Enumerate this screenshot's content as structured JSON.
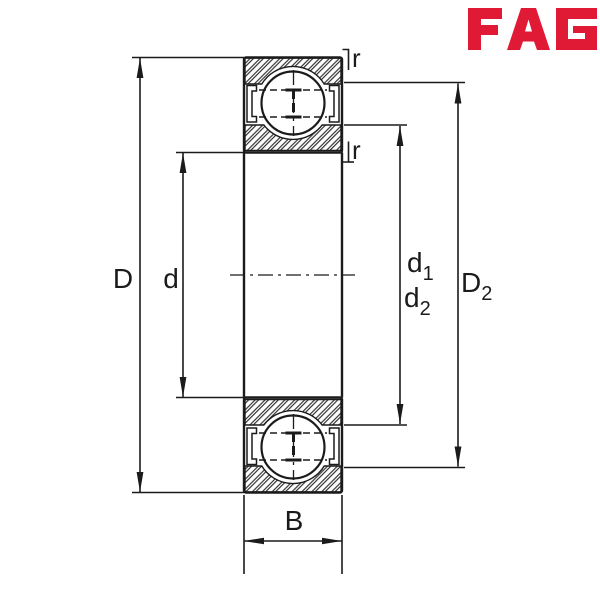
{
  "page": {
    "title": "Bearing dimension drawing",
    "background": "#ffffff"
  },
  "logo": {
    "text": "FAG",
    "color": "#E01A35"
  },
  "drawing": {
    "line_color": "#1b1b1b",
    "component": "deep-groove-ball-bearing-cross-section-with-shields"
  },
  "dim_labels": {
    "outer_diameter": "D",
    "bore_diameter": "d",
    "d1": {
      "base": "d",
      "sub": "1"
    },
    "d2": {
      "base": "d",
      "sub": "2"
    },
    "D2": {
      "base": "D",
      "sub": "2"
    },
    "width": "B",
    "radius_top": "r",
    "radius_bottom": "r"
  }
}
